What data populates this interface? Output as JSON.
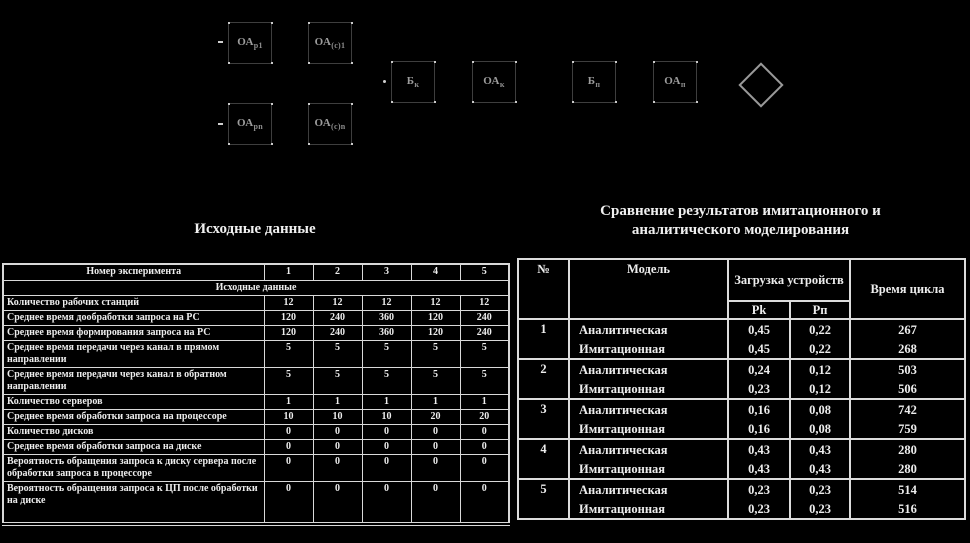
{
  "colors": {
    "background": "#000000",
    "text": "#ededed",
    "table_border": "#d9d9d9",
    "diagram_box_border": "#3e3e3e",
    "diagram_label": "#9d9d9d",
    "handle_dot": "#c9c9c9"
  },
  "diagram": {
    "boxes": [
      {
        "main": "ОА",
        "sub": "р1"
      },
      {
        "main": "ОА",
        "sub": "(с)1"
      },
      {
        "main": "ОА",
        "sub": "рn"
      },
      {
        "main": "ОА",
        "sub": "(с)n"
      },
      {
        "main": "Б",
        "sub": "к"
      },
      {
        "main": "ОА",
        "sub": "к"
      },
      {
        "main": "Б",
        "sub": "п"
      },
      {
        "main": "ОА",
        "sub": "п"
      }
    ]
  },
  "left": {
    "title": "Исходные данные",
    "table": {
      "header_label": "Номер эксперимента",
      "exp_numbers": [
        "1",
        "2",
        "3",
        "4",
        "5"
      ],
      "section_label": "Исходные  данные",
      "rows": [
        {
          "label": "Количество рабочих станций",
          "values": [
            "12",
            "12",
            "12",
            "12",
            "12"
          ]
        },
        {
          "label": "Среднее время дообработки запроса на РС",
          "values": [
            "120",
            "240",
            "360",
            "120",
            "240"
          ]
        },
        {
          "label": "Среднее время формирования запроса на РС",
          "values": [
            "120",
            "240",
            "360",
            "120",
            "240"
          ]
        },
        {
          "label": "Среднее время передачи через канал в прямом направлении",
          "values": [
            "5",
            "5",
            "5",
            "5",
            "5"
          ]
        },
        {
          "label": "Среднее время передачи через канал в обратном направлении",
          "values": [
            "5",
            "5",
            "5",
            "5",
            "5"
          ]
        },
        {
          "label": "Количество серверов",
          "values": [
            "1",
            "1",
            "1",
            "1",
            "1"
          ]
        },
        {
          "label": "Среднее время обработки запроса на процессоре",
          "values": [
            "10",
            "10",
            "10",
            "20",
            "20"
          ]
        },
        {
          "label": "Количество дисков",
          "values": [
            "0",
            "0",
            "0",
            "0",
            "0"
          ]
        },
        {
          "label": "Среднее время обработки запроса на диске",
          "values": [
            "0",
            "0",
            "0",
            "0",
            "0"
          ]
        },
        {
          "label": "Вероятность обращения запроса к диску сервера после обработки запроса в процессоре",
          "values": [
            "0",
            "0",
            "0",
            "0",
            "0"
          ]
        },
        {
          "label": "Вероятность  обращения запроса к ЦП после обработки на диске",
          "values": [
            "0",
            "0",
            "0",
            "0",
            "0"
          ]
        }
      ]
    }
  },
  "right": {
    "title_line1": "Сравнение результатов имитационного и",
    "title_line2": "аналитического моделирования",
    "table": {
      "col_no": "№",
      "col_model": "Модель",
      "col_load": "Загрузка устройств",
      "col_pk": "Pk",
      "col_pn": "Pп",
      "col_cycle": "Время цикла",
      "groups": [
        {
          "no": "1",
          "rows": [
            {
              "model": "Аналитическая",
              "pk": "0,45",
              "pn": "0,22",
              "cycle": "267"
            },
            {
              "model": "Имитационная",
              "pk": "0,45",
              "pn": "0,22",
              "cycle": "268"
            }
          ]
        },
        {
          "no": "2",
          "rows": [
            {
              "model": "Аналитическая",
              "pk": "0,24",
              "pn": "0,12",
              "cycle": "503"
            },
            {
              "model": "Имитационная",
              "pk": "0,23",
              "pn": "0,12",
              "cycle": "506"
            }
          ]
        },
        {
          "no": "3",
          "rows": [
            {
              "model": "Аналитическая",
              "pk": "0,16",
              "pn": "0,08",
              "cycle": "742"
            },
            {
              "model": "Имитационная",
              "pk": "0,16",
              "pn": "0,08",
              "cycle": "759"
            }
          ]
        },
        {
          "no": "4",
          "rows": [
            {
              "model": "Аналитическая",
              "pk": "0,43",
              "pn": "0,43",
              "cycle": "280"
            },
            {
              "model": "Имитационная",
              "pk": "0,43",
              "pn": "0,43",
              "cycle": "280"
            }
          ]
        },
        {
          "no": "5",
          "rows": [
            {
              "model": "Аналитическая",
              "pk": "0,23",
              "pn": "0,23",
              "cycle": "514"
            },
            {
              "model": "Имитационная",
              "pk": "0,23",
              "pn": "0,23",
              "cycle": "516"
            }
          ]
        }
      ]
    }
  }
}
